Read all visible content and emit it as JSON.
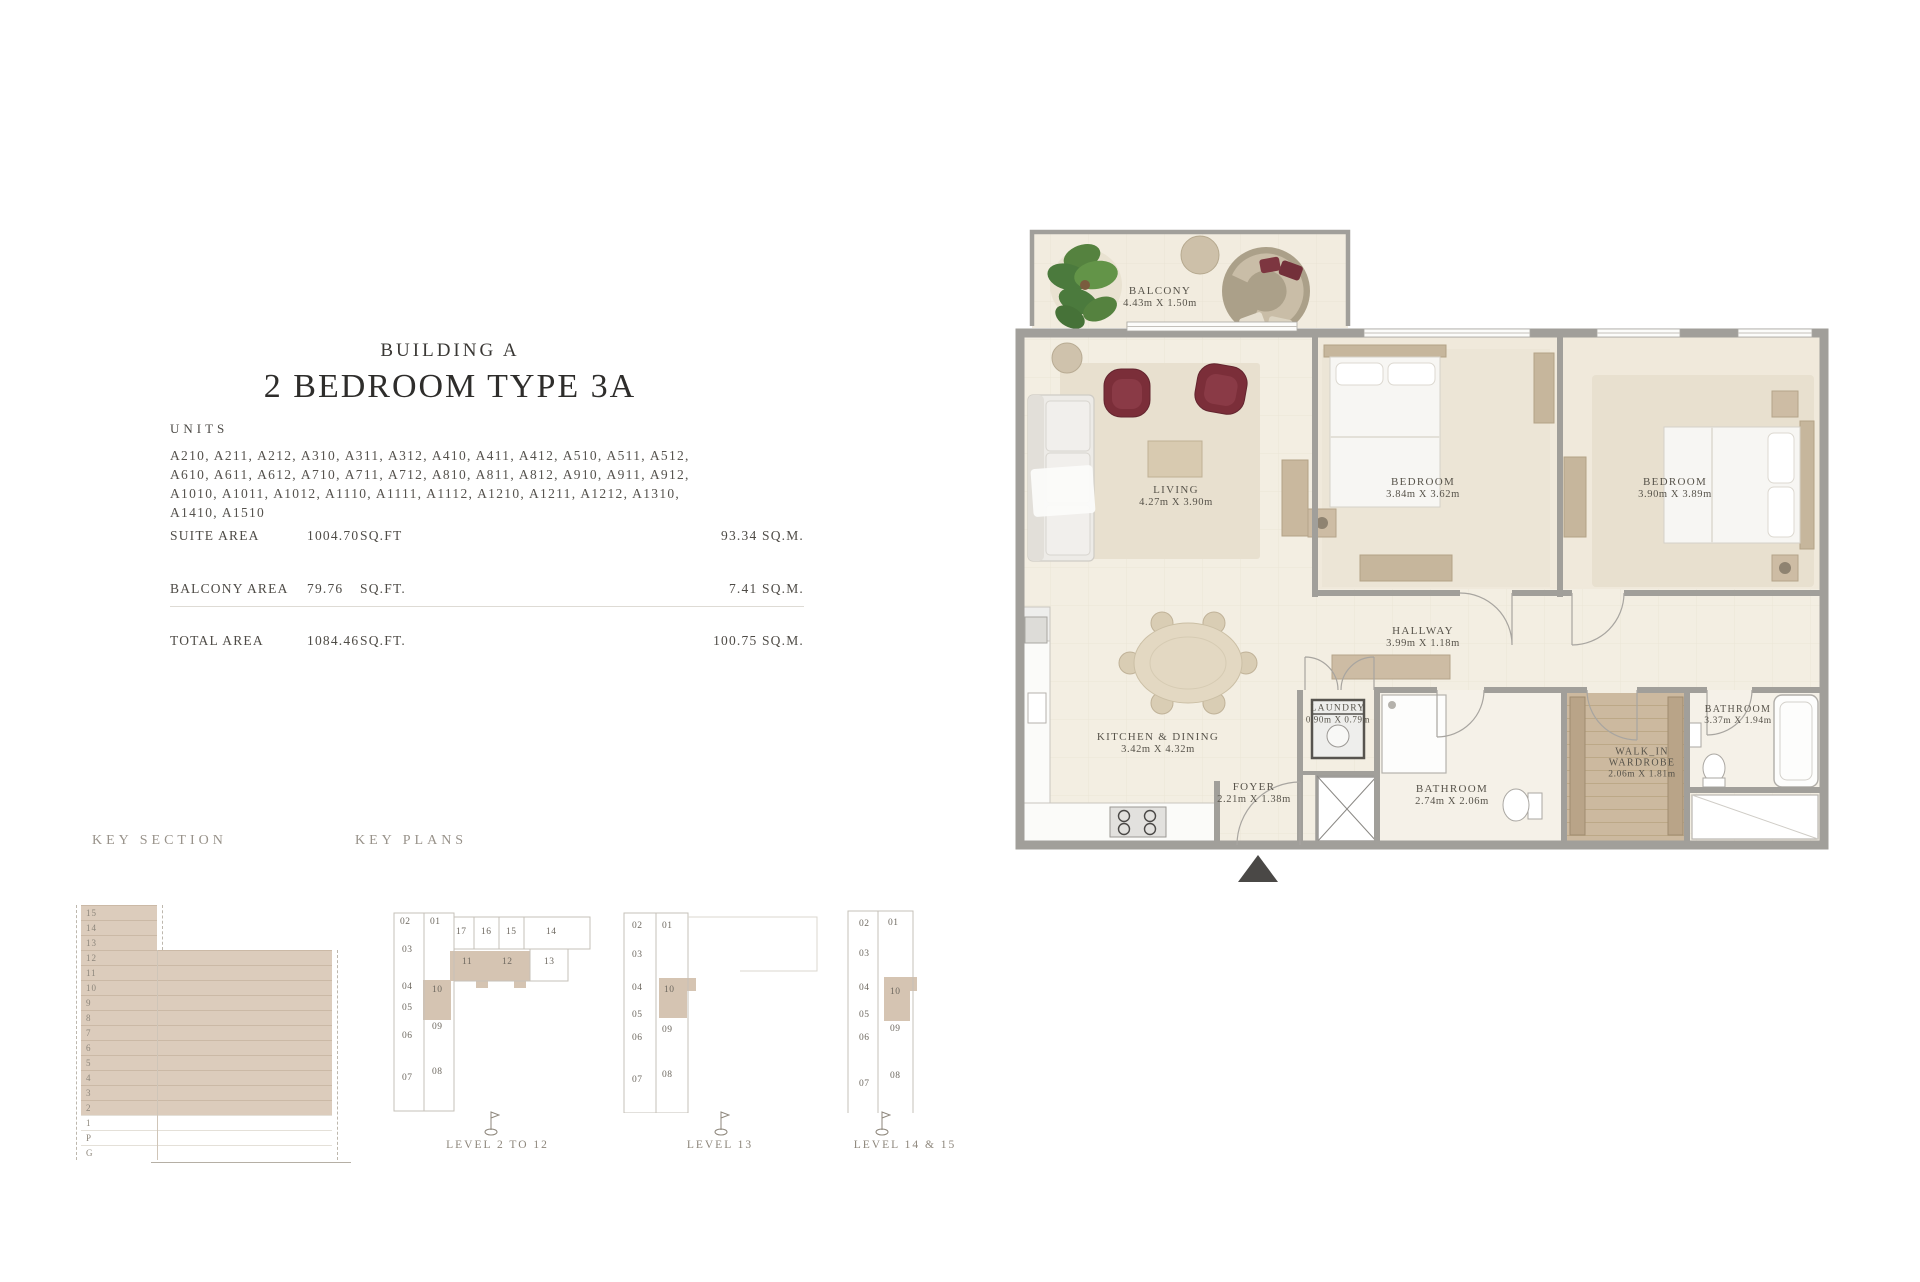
{
  "header": {
    "building": "BUILDING A",
    "title": "2 BEDROOM TYPE 3A",
    "units_label": "UNITS",
    "units_lines": [
      "A210, A211, A212, A310, A311, A312, A410, A411, A412, A510, A511, A512,",
      "A610, A611, A612, A710, A711, A712, A810, A811, A812, A910, A911, A912,",
      "A1010, A1011, A1012, A1110, A1111, A1112, A1210, A1211, A1212, A1310,",
      "A1410, A1510"
    ]
  },
  "areas": {
    "rows": [
      {
        "label": "SUITE AREA",
        "value": "1004.70",
        "unit": "SQ.FT",
        "metric": "93.34 SQ.M."
      },
      {
        "label": "BALCONY AREA",
        "value": "79.76",
        "unit": "SQ.FT.",
        "metric": "7.41 SQ.M."
      },
      {
        "label": "TOTAL AREA",
        "value": "1084.46",
        "unit": "SQ.FT.",
        "metric": "100.75 SQ.M."
      }
    ]
  },
  "floor_plan": {
    "rooms": {
      "balcony": {
        "name": "BALCONY",
        "dims": "4.43m X 1.50m"
      },
      "living": {
        "name": "LIVING",
        "dims": "4.27m X 3.90m"
      },
      "bedroom1": {
        "name": "BEDROOM",
        "dims": "3.84m X 3.62m"
      },
      "bedroom2": {
        "name": "BEDROOM",
        "dims": "3.90m X 3.89m"
      },
      "hallway": {
        "name": "HALLWAY",
        "dims": "3.99m X 1.18m"
      },
      "laundry": {
        "name": "LAUNDRY",
        "dims": "0.90m X 0.79m"
      },
      "kitchen": {
        "name": "KITCHEN & DINING",
        "dims": "3.42m X 4.32m"
      },
      "foyer": {
        "name": "FOYER",
        "dims": "2.21m X 1.38m"
      },
      "bathroom1": {
        "name": "BATHROOM",
        "dims": "2.74m X 2.06m"
      },
      "wardrobe": {
        "name_line1": "WALK_IN",
        "name_line2": "WARDROBE",
        "dims": "2.06m X 1.81m"
      },
      "bathroom2": {
        "name": "BATHROOM",
        "dims": "3.37m X 1.94m"
      }
    }
  },
  "key_section": {
    "heading": "KEY SECTION",
    "floors": [
      "15",
      "14",
      "13",
      "12",
      "11",
      "10",
      "9",
      "8",
      "7",
      "6",
      "5",
      "4",
      "3",
      "2",
      "1",
      "P",
      "G"
    ]
  },
  "key_plans": {
    "heading": "KEY PLANS",
    "plans": [
      {
        "label": "LEVEL 2 TO 12",
        "units": [
          "02",
          "01",
          "17",
          "16",
          "15",
          "14",
          "03",
          "11",
          "12",
          "13",
          "10",
          "04",
          "05",
          "09",
          "06",
          "07",
          "08"
        ],
        "highlighted": [
          "10",
          "11",
          "12"
        ]
      },
      {
        "label": "LEVEL 13",
        "units": [
          "02",
          "01",
          "03",
          "04",
          "10",
          "05",
          "09",
          "06",
          "07",
          "08"
        ],
        "highlighted": [
          "10"
        ]
      },
      {
        "label": "LEVEL 14 & 15",
        "units": [
          "02",
          "01",
          "03",
          "04",
          "10",
          "05",
          "09",
          "06",
          "07",
          "08"
        ],
        "highlighted": [
          "10"
        ]
      }
    ]
  },
  "colors": {
    "highlight_tan": "#d5c4b2",
    "key_block_tan": "#dcccbc",
    "wall_gray": "#a19f9a",
    "floor_cream": "#f3eee2",
    "wood": "#c6b69c",
    "burgundy": "#7b2e39",
    "text": "#4e4b46"
  }
}
